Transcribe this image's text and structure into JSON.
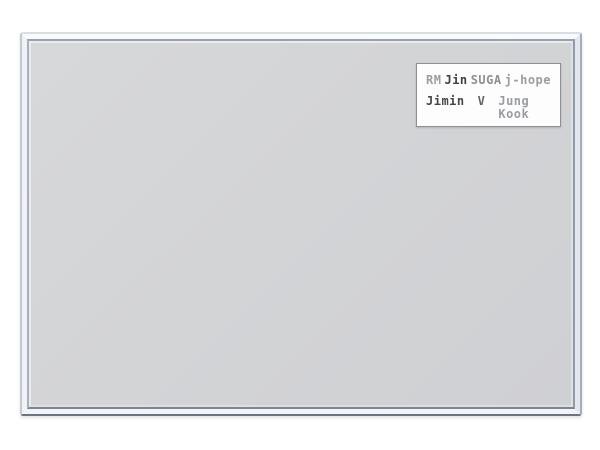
{
  "page": {
    "background": "#ffffff"
  },
  "board": {
    "kind": "framed notice board",
    "frame_style": "silver-aluminum",
    "surface_color": "#d3d4d6",
    "frame_highlight_color": "#fafbfd",
    "frame_shadow_color": "#6b7484"
  },
  "label": {
    "background": "#fdfdfd",
    "border_color": "#8f9092",
    "row1": [
      {
        "name": "RM",
        "color": "#9a9ea1"
      },
      {
        "name": "Jin",
        "color": "#3f4143"
      },
      {
        "name": "SUGA",
        "color": "#8d9194"
      },
      {
        "name": "j-hope",
        "color": "#9a9ea1"
      }
    ],
    "row2": [
      {
        "name": "Jimin",
        "color": "#454749"
      },
      {
        "name": "V",
        "color": "#606264"
      },
      {
        "name": "Jung Kook",
        "color": "#9a9da0"
      }
    ]
  }
}
